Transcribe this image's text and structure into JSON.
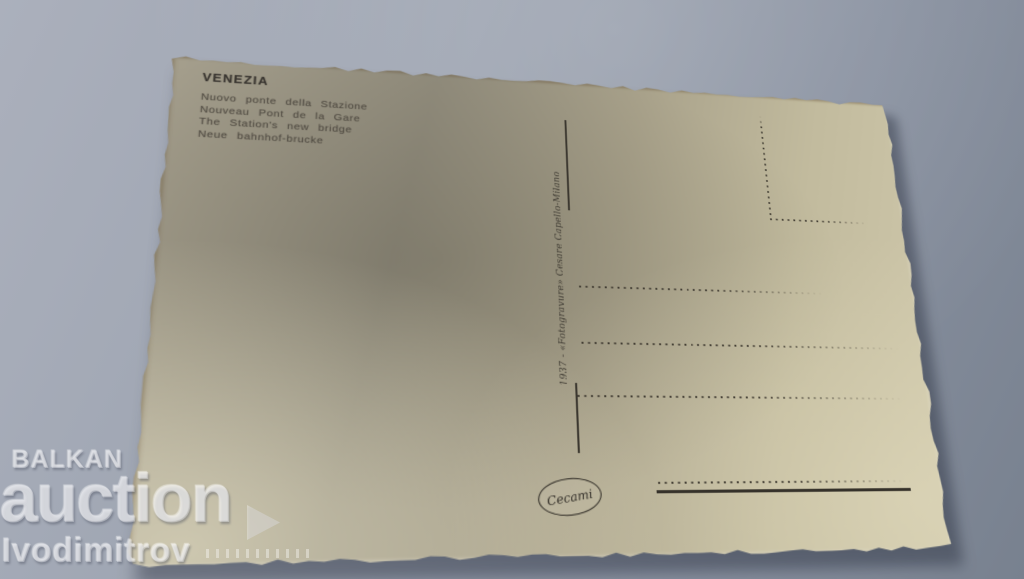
{
  "photo": {
    "colors": {
      "background": "#8f97a5",
      "card_paper": "#c2bb9e",
      "card_shadow_region": "#8e897a",
      "ink": "#46423a",
      "watermark": "#e9eaef"
    }
  },
  "postcard": {
    "title": "VENEZIA",
    "captions": [
      "Nuovo ponte della Stazione",
      "Nouveau Pont de la Gare",
      "The Station's new bridge",
      "Neue bahnhof-brucke"
    ],
    "imprint": "1937 - «Fotogravure» Cesare Capello-Milano",
    "publisher": "Cecami"
  },
  "watermark": {
    "line1": "BALKAN",
    "line2": "auction",
    "line3": "Ivodimitrov",
    "arrow_icon": "play-triangle"
  }
}
